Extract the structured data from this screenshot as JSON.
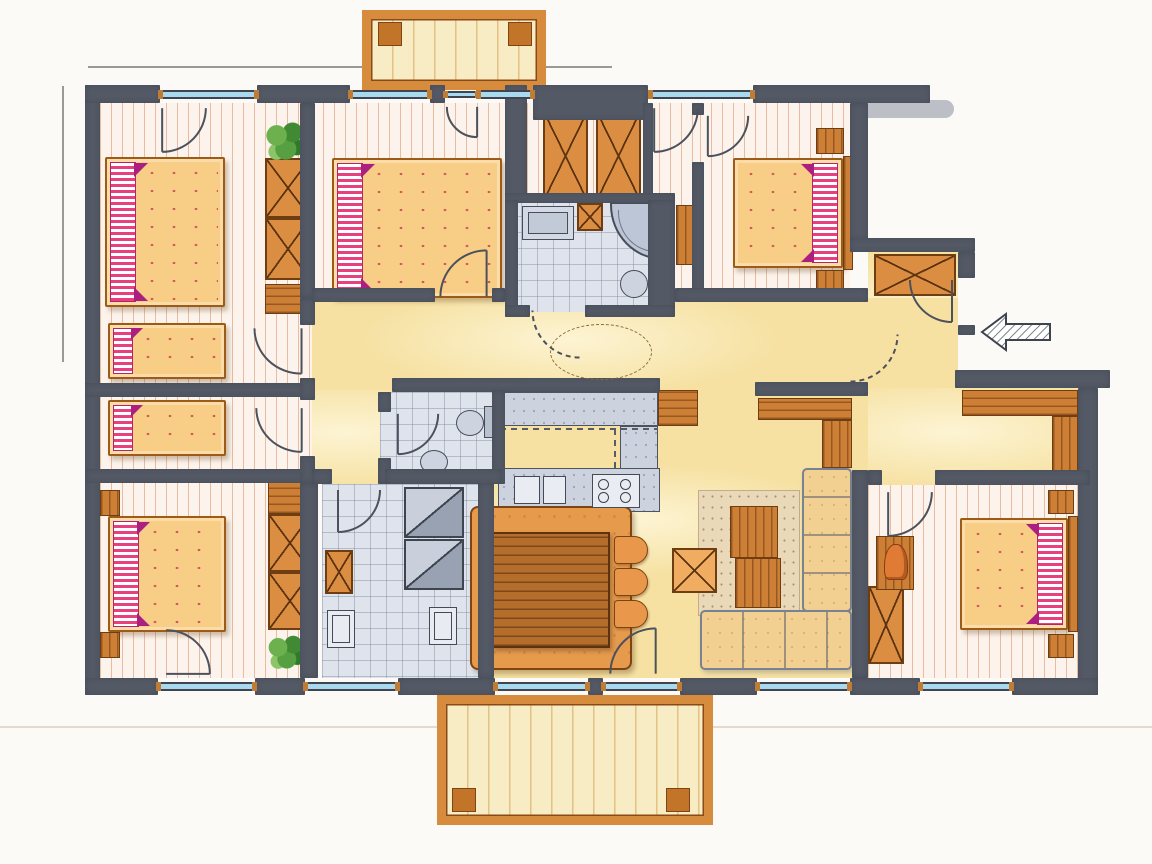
{
  "document": {
    "kind": "hand-drawn architectural floor plan, marker rendering",
    "text_labels": [],
    "annotations": [
      "entrance-arrow-east-pointing-west",
      "dashed-circle-in-corridor",
      "dimension-lines-top-left",
      "roof-overhang-top-right"
    ]
  },
  "palette": {
    "wall": "#535965",
    "plank_floor": "#fcf4ec",
    "plank_stripe": "#c6602c",
    "hall_floor": "#f6e1a2",
    "tile_floor": "#dfe3ec",
    "counter": "#ccd3df",
    "bed_fill": "#f8cd85",
    "pillow_stripe": "#e8407e",
    "blanket_accent": "#b2256b",
    "wood_light": "#db8e41",
    "wood_dark": "#b46d2a",
    "bench": "#f2d092",
    "chair": "#e9974b",
    "window_glass": "#a9d9ef",
    "window_tick": "#c07c33",
    "deck": "#f8ecc4",
    "deck_frame": "#d78b3c",
    "plant": "#57a041",
    "paper": "#fbfaf6"
  },
  "rooms": [
    {
      "id": "bedroom-nw",
      "furniture": [
        "double-bed",
        "single-bed",
        "wardrobe-2-sections",
        "shoe-bench",
        "plant"
      ]
    },
    {
      "id": "bedroom-w-small",
      "furniture": [
        "single-bed"
      ]
    },
    {
      "id": "bedroom-sw",
      "furniture": [
        "double-bed",
        "nightstand",
        "nightstand",
        "wardrobe-2-sections",
        "angled-cabinet",
        "plant"
      ]
    },
    {
      "id": "bedroom-n",
      "furniture": [
        "double-bed",
        "balcony-door"
      ]
    },
    {
      "id": "closet-nook",
      "furniture": [
        "wardrobe",
        "wardrobe"
      ]
    },
    {
      "id": "corridor-north",
      "furniture": [
        "tall-shelf",
        "garden-door"
      ]
    },
    {
      "id": "bathroom",
      "furniture": [
        "vanity-sink",
        "service-shaft",
        "corner-shower",
        "toilet",
        "tall-cabinet"
      ]
    },
    {
      "id": "bedroom-ne",
      "furniture": [
        "double-bed",
        "headboard-panel",
        "nightstand",
        "nightstand"
      ]
    },
    {
      "id": "entry-vestibule",
      "furniture": [
        "wardrobe",
        "entrance-door",
        "entrance-arrow"
      ]
    },
    {
      "id": "hall-corridor",
      "furniture": [
        "dashed-circle-annotation"
      ]
    },
    {
      "id": "corridor-west",
      "furniture": []
    },
    {
      "id": "wc",
      "furniture": [
        "toilet",
        "hand-basin"
      ]
    },
    {
      "id": "utility-room",
      "furniture": [
        "washer",
        "dryer",
        "x-cabinet",
        "base-cabinet",
        "base-cabinet"
      ]
    },
    {
      "id": "kitchen",
      "furniture": [
        "upper-counter",
        "tall-wood-cabinet",
        "mid-counter",
        "sink-counter",
        "cooktop-4-burners"
      ]
    },
    {
      "id": "living-dining",
      "furniture": [
        "dining-platform",
        "wood-table",
        "chair",
        "chair",
        "chair",
        "stool",
        "side-table",
        "side-table",
        "speckled-rug",
        "corner-bench-L",
        "sideboard-L",
        "terrace-door"
      ]
    },
    {
      "id": "bench-nook",
      "furniture": [
        "wall-bench-L"
      ]
    },
    {
      "id": "bedroom-se",
      "furniture": [
        "double-bed",
        "headboard-panel",
        "nightstand",
        "nightstand",
        "wardrobe",
        "console",
        "vase"
      ]
    },
    {
      "id": "balcony-north",
      "furniture": [
        "wood-deck",
        "post",
        "post"
      ]
    },
    {
      "id": "terrace-south",
      "furniture": [
        "wood-deck",
        "post",
        "post"
      ]
    }
  ],
  "openings": {
    "windows_top_wall": 4,
    "windows_bottom_wall": 6,
    "interior_doors": 10,
    "exterior_doors": 4,
    "entrance_side": "east"
  }
}
